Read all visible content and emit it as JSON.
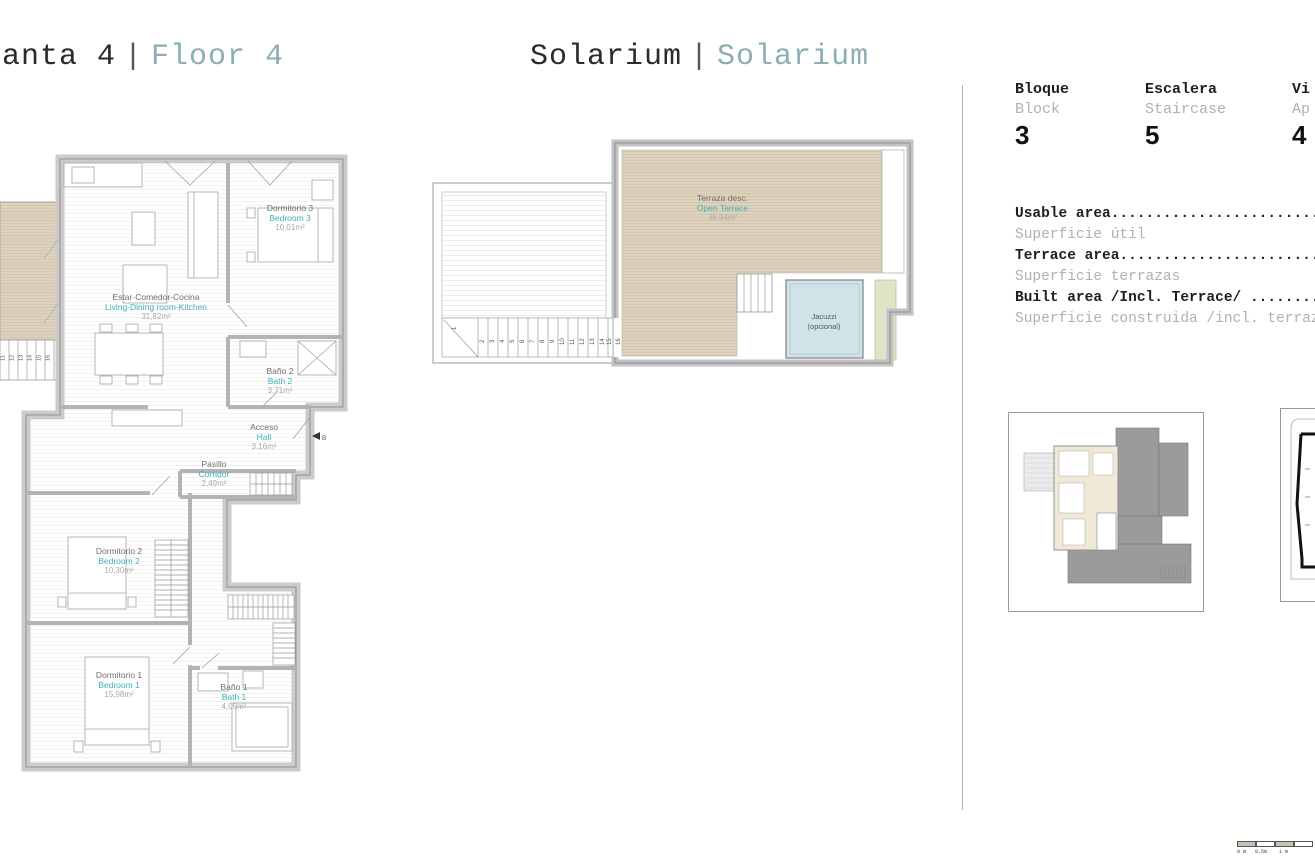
{
  "page": {
    "title_left": {
      "es": "anta 4",
      "sep": "|",
      "en": "Floor 4"
    },
    "title_center": {
      "es": "Solarium",
      "sep": "|",
      "en": "Solarium"
    }
  },
  "info_panel": {
    "columns": [
      {
        "es": "Bloque",
        "en": "Block",
        "value": "3"
      },
      {
        "es": "Escalera",
        "en": "Staircase",
        "value": "5"
      },
      {
        "es": "Vi",
        "en": "Ap",
        "value": "4"
      }
    ],
    "areas": [
      {
        "en": "Usable area.........................",
        "es": "Superficie útil"
      },
      {
        "en": "Terrace area........................",
        "es": "Superficie terrazas"
      },
      {
        "en": "Built area /Incl. Terrace/ .........",
        "es": "Superficie construida /incl. terraz"
      }
    ]
  },
  "floor_plan": {
    "rooms": [
      {
        "es": "Dormitorio 3",
        "en": "Bedroom 3",
        "area": "10,01m²"
      },
      {
        "es": "Estar-Comedor-Cocina",
        "en": "Living-Dining room-Kitchen",
        "area": "31,82m²"
      },
      {
        "es": "Baño 2",
        "en": "Bath 2",
        "area": "3,71m²"
      },
      {
        "es": "Acceso",
        "en": "Hall",
        "area": "3,16m²"
      },
      {
        "es": "Pasillo",
        "en": "Corridor",
        "area": "2,49m²"
      },
      {
        "es": "Dormitorio 2",
        "en": "Bedroom 2",
        "area": "10,30m²"
      },
      {
        "es": "Dormitorio 1",
        "en": "Bedroom 1",
        "area": "15,98m²"
      },
      {
        "es": "Baño 1",
        "en": "Bath 1",
        "area": "4,09m²"
      }
    ],
    "stair_steps": [
      "11",
      "12",
      "13",
      "14",
      "15",
      "16"
    ],
    "section_marker": "B"
  },
  "solarium_plan": {
    "terrace": {
      "es": "Terraza desc.",
      "en": "Open Terrace",
      "area": "36,94m²"
    },
    "jacuzzi": {
      "line1": "Jacuzzi",
      "line2": "(opcional)"
    },
    "stair_steps": [
      "1",
      "2",
      "3",
      "4",
      "5",
      "6",
      "7",
      "8",
      "9",
      "10",
      "11",
      "12",
      "13",
      "14",
      "15",
      "16"
    ]
  },
  "scale_bar": {
    "labels": [
      "0 m",
      "0.5m",
      "1 m"
    ]
  },
  "colors": {
    "accent_teal": "#41aebc",
    "muted_teal": "#8caeb2",
    "deck_beige": "#ded2bd",
    "jacuzzi_blue": "#cfe3e8"
  }
}
